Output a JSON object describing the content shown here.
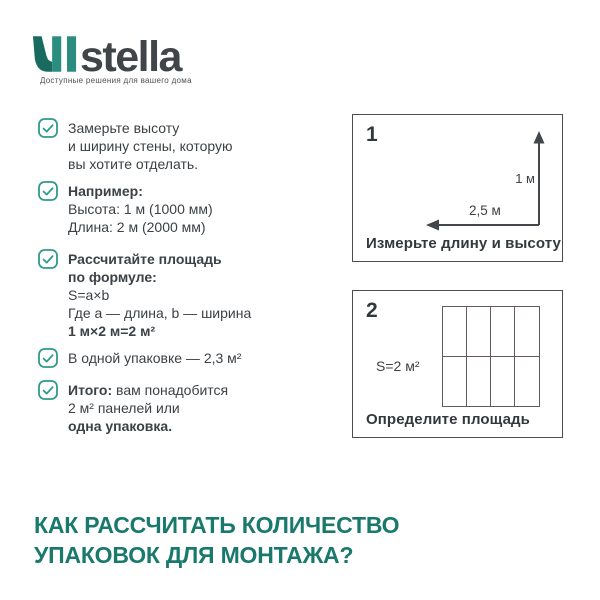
{
  "logo": {
    "brand": "stella",
    "tagline": "Доступные решения для вашего дома"
  },
  "checklist": {
    "items": [
      {
        "line1": "Замерьте высоту",
        "line2": "и ширину стены, которую",
        "line3": "вы хотите отделать."
      },
      {
        "title": "Например:",
        "line1": "Высота: 1 м (1000 мм)",
        "line2": "Длина: 2 м (2000 мм)"
      },
      {
        "title1": "Рассчитайте площадь",
        "title2": "по формуле:",
        "line1": "S=a×b",
        "line2": "Где a — длина, b — ширина",
        "line3_bold": "1 м×2 м=2 м²"
      },
      {
        "line1": "В одной упаковке — 2,3 м²"
      },
      {
        "prefix_bold": "Итого:",
        "rest": " вам понадобится",
        "line2": "2 м² панелей или",
        "line3_bold": "одна упаковка."
      }
    ]
  },
  "figures": [
    {
      "number": "1",
      "height_label": "1 м",
      "length_label": "2,5 м",
      "caption": "Измерьте длину и высоту"
    },
    {
      "number": "2",
      "area_label": "S=2 м²",
      "grid_cols": 4,
      "grid_rows": 2,
      "caption": "Определите площадь"
    }
  ],
  "heading": {
    "line1": "КАК РАССЧИТАТЬ КОЛИЧЕСТВО",
    "line2": "УПАКОВОК ДЛЯ МОНТАЖА?"
  },
  "colors": {
    "accent_teal": "#2f9a8d",
    "heading_teal": "#19796c",
    "logo_teal_dark": "#196b60",
    "logo_teal": "#2b8d80",
    "text": "#3c4145",
    "panel_border": "#4a4e52"
  }
}
